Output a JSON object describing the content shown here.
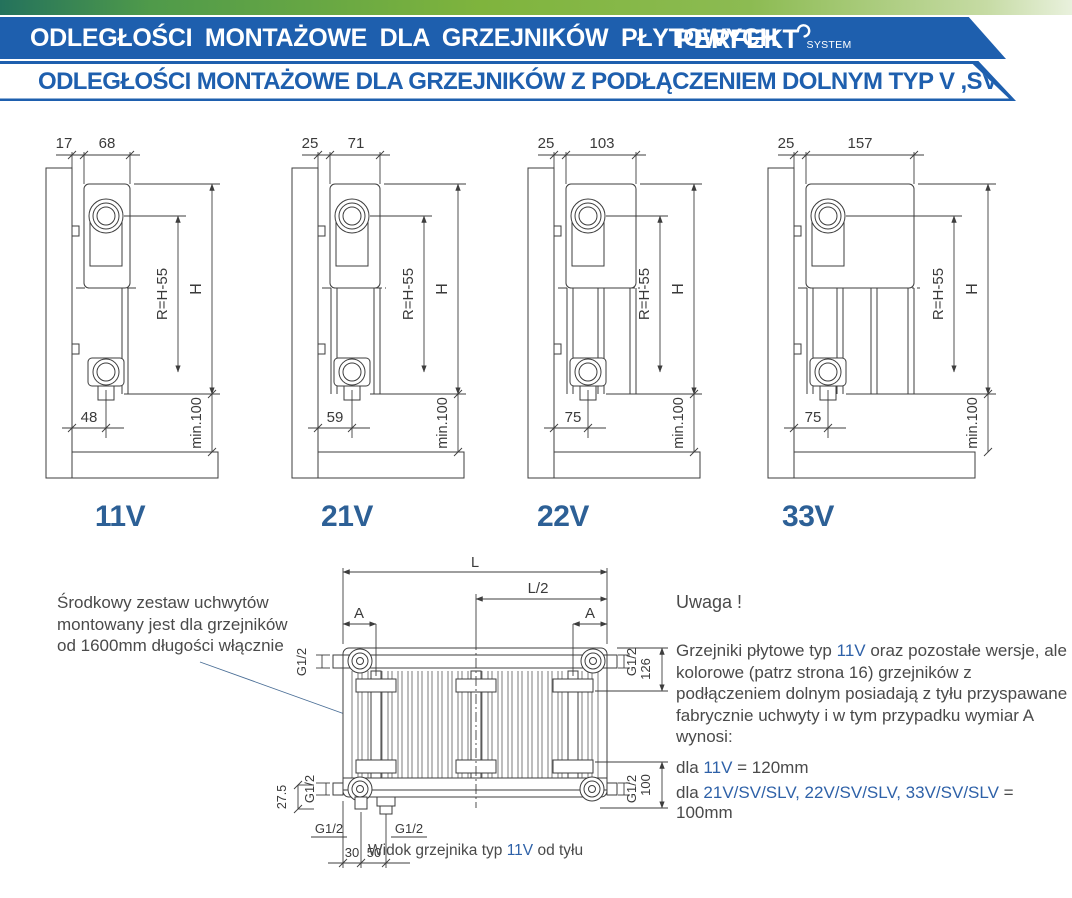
{
  "header": {
    "top_title": "ODLEGŁOŚCI MONTAŻOWE DLA GRZEJNIKÓW PŁYTOWYCH",
    "brand": "PERFEKT",
    "brand_sub": "SYSTEM",
    "subtitle": "ODLEGŁOŚCI MONTAŻOWE DLA GRZEJNIKÓW Z PODŁĄCZENIEM DOLNYM TYP V ,SV ,SLV",
    "colors": {
      "banner_blue": "#1e5fae",
      "green_dark": "#24725c",
      "green_light": "#7fb43d",
      "accent_blue": "#2e61a8"
    }
  },
  "diagrams": [
    {
      "type_label": "11V",
      "wall_gap": "17",
      "depth": "68",
      "radius_label": "R=H-55",
      "height_label": "H",
      "bottom_offset": "48",
      "floor_clearance": "min.100"
    },
    {
      "type_label": "21V",
      "wall_gap": "25",
      "depth": "71",
      "radius_label": "R=H-55",
      "height_label": "H",
      "bottom_offset": "59",
      "floor_clearance": "min.100"
    },
    {
      "type_label": "22V",
      "wall_gap": "25",
      "depth": "103",
      "radius_label": "R=H-55",
      "height_label": "H",
      "bottom_offset": "75",
      "floor_clearance": "min.100"
    },
    {
      "type_label": "33V",
      "wall_gap": "25",
      "depth": "157",
      "radius_label": "R=H-55",
      "height_label": "H",
      "bottom_offset": "75",
      "floor_clearance": "min.100"
    }
  ],
  "back_view": {
    "length_label": "L",
    "half_length_label": "L/2",
    "bracket_offset_label": "A",
    "thread_label": "G1/2",
    "height_dim": "126",
    "bottom_dim": "100",
    "offset_dim": "27.5",
    "pipe_spacing_1": "30",
    "pipe_spacing_2": "50",
    "caption_prefix": "Widok grzejnika typ ",
    "caption_type": "11V",
    "caption_suffix": " od tyłu"
  },
  "notes": {
    "left_lines": [
      "Środkowy zestaw uchwytów",
      "montowany jest dla grzejników",
      "od 1600mm długości włącznie"
    ],
    "warning_title": "Uwaga !",
    "warning_parts": [
      "Grzejniki płytowe typ ",
      "11V",
      " oraz pozostałe wersje, ale kolorowe (patrz strona 16) grzejników z podłączeniem dolnym posiadają z tyłu przyspawane fabrycznie uchwyty i w tym przypadku wymiar A wynosi:"
    ],
    "rule1": [
      "dla ",
      "11V",
      " = 120mm"
    ],
    "rule2": [
      "dla ",
      "21V/SV/SLV, 22V/SV/SLV, 33V/SV/SLV",
      " = 100mm"
    ]
  }
}
